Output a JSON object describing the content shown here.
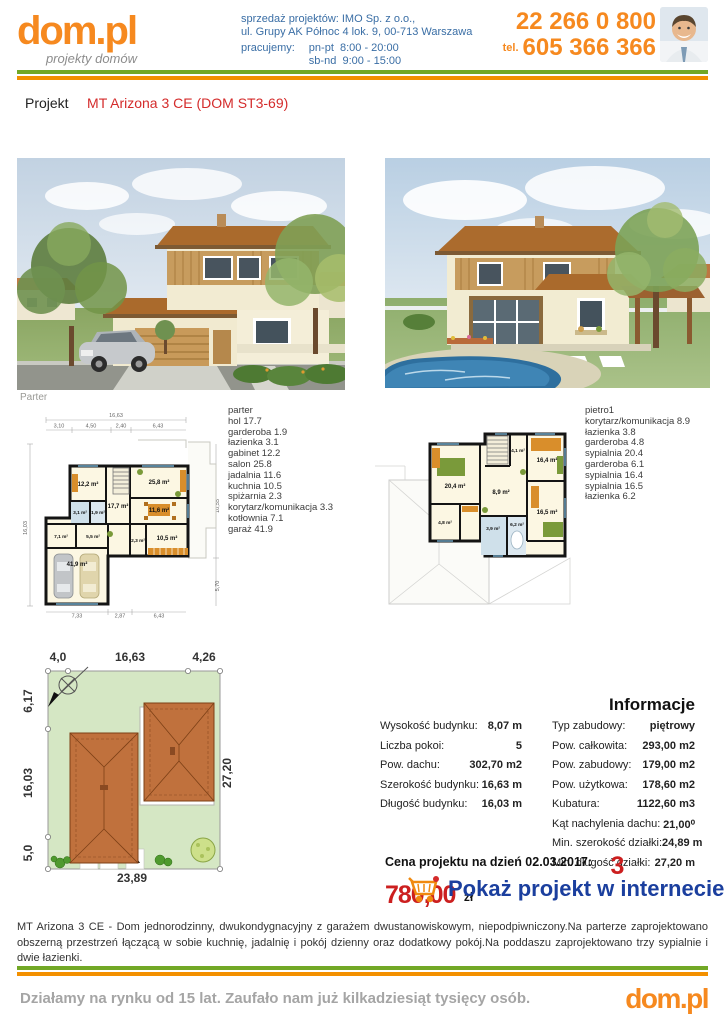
{
  "header": {
    "logo": "dom.pl",
    "logo_tagline": "projekty domów",
    "seller_line1": "sprzedaż projektów: IMO Sp. z o.o.,",
    "seller_line2": "ul. Grupy AK Północ 4 lok. 9, 00-713 Warszawa",
    "hours_label": "pracujemy:",
    "hours": [
      {
        "days": "pn-pt",
        "time": "8:00 - 20:00"
      },
      {
        "days": "sb-nd",
        "time": "9:00 - 15:00"
      }
    ],
    "phone_main": "22 266 0 800",
    "phone_prefix": "tel.",
    "phone_mobile": "605 366 366"
  },
  "project": {
    "label": "Projekt",
    "title": "MT Arizona 3 CE (DOM ST3-69)"
  },
  "renders": {
    "front_caption": "Parter"
  },
  "plans": {
    "parter": {
      "title": "parter",
      "rooms": [
        "hol 17.7",
        "garderoba 1.9",
        "łazienka 3.1",
        "gabinet 12.2",
        "salon 25.8",
        "jadalnia 11.6",
        "kuchnia 10.5",
        "spiżarnia 2.3",
        "korytarz/komunikacja 3.3",
        "kotłownia 7.1",
        "garaż 41.9"
      ],
      "labels": {
        "gabinet": "12,2 m²",
        "lazienka": "3,1 m²",
        "wc": "1,9 m²",
        "kotlownia": "7,1 m²",
        "korytarz": "5,5 m²",
        "hol": "17,7 m²",
        "garaz": "41,9 m²",
        "salon": "25,8 m²",
        "jadalnia": "11,6 m²",
        "kuchnia": "10,5 m²",
        "spizarnia": "2,3 m²"
      },
      "dims": {
        "top_total": "16,63",
        "top": [
          "3,10",
          "4,50",
          "2,40",
          "6,43"
        ],
        "left": "16,03",
        "right_top": "10,55",
        "right_bottom": "5,70",
        "bottom": [
          "7,33",
          "2,87",
          "6,43"
        ]
      }
    },
    "pietro": {
      "title": "pietro1",
      "rooms": [
        "korytarz/komunikacja 8.9",
        "łazienka 3.8",
        "garderoba 4.8",
        "sypialnia 20.4",
        "garderoba 6.1",
        "sypialnia 16.4",
        "sypialnia 16.5",
        "łazienka 6.2"
      ],
      "labels": {
        "sypialnia1": "20,4 m²",
        "garderoba1": "4,8 m²",
        "korytarz": "8,9 m²",
        "garderoba2": "4,1 m²",
        "sypialnia2": "16,4 m²",
        "sypialnia3": "16,5 m²",
        "lazienka1": "3,9 m²",
        "lazienka2": "6,2 m²"
      }
    }
  },
  "site_plan": {
    "dims": {
      "top_left": "4,0",
      "top_center": "16,63",
      "top_right": "4,26",
      "left_top": "6,17",
      "left_center": "16,03",
      "left_bottom": "5,0",
      "right": "27,20",
      "bottom": "23,89"
    }
  },
  "info": {
    "heading": "Informacje",
    "left": [
      {
        "label": "Wysokość budynku:",
        "value": "8,07 m"
      },
      {
        "label": "Liczba pokoi:",
        "value": "5"
      },
      {
        "label": "Pow. dachu:",
        "value": "302,70 m2"
      },
      {
        "label": "Szerokość budynku:",
        "value": "16,63 m"
      },
      {
        "label": "Długość budynku:",
        "value": "16,03 m"
      }
    ],
    "right": [
      {
        "label": "Typ zabudowy:",
        "value": "piętrowy"
      },
      {
        "label": "Pow. całkowita:",
        "value": "293,00 m2"
      },
      {
        "label": "Pow. zabudowy:",
        "value": "179,00 m2"
      },
      {
        "label": "Pow. użytkowa:",
        "value": "178,60 m2"
      },
      {
        "label": "Kubatura:",
        "value": "1122,60 m3"
      },
      {
        "label": "Kąt nachylenia dachu:",
        "value": "21,00⁰"
      },
      {
        "label": "Min. szerokość działki:",
        "value": "24,89 m"
      },
      {
        "label": "Min. długość działki:",
        "value": "27,20 m"
      }
    ]
  },
  "price": {
    "label": "Cena projektu na dzień 02.03.2017:",
    "amount": "3 780,00",
    "currency": "zł"
  },
  "cta": {
    "label": "Pokaż projekt w internecie"
  },
  "description": "MT Arizona 3 CE - Dom jednorodzinny, dwukondygnacyjny z garażem dwustanowiskowym, niepodpiwniczony.Na parterze zaprojektowano obszerną przestrzeń łączącą w sobie kuchnię, jadalnię i pokój dzienny oraz dodatkowy pokój.Na poddaszu zaprojektowano trzy sypialnie i dwie łazienki.",
  "footer": {
    "text": "Działamy na rynku od 15 lat. Zaufało nam już kilkadziesiąt tysięcy osób.",
    "logo": "dom.pl"
  },
  "colors": {
    "orange": "#f6891f",
    "green_bar": "#72a826",
    "orange_bar": "#f39000",
    "red": "#cc1f1f",
    "blue_text": "#3a6ea5",
    "cta_blue": "#1b3f9e"
  }
}
